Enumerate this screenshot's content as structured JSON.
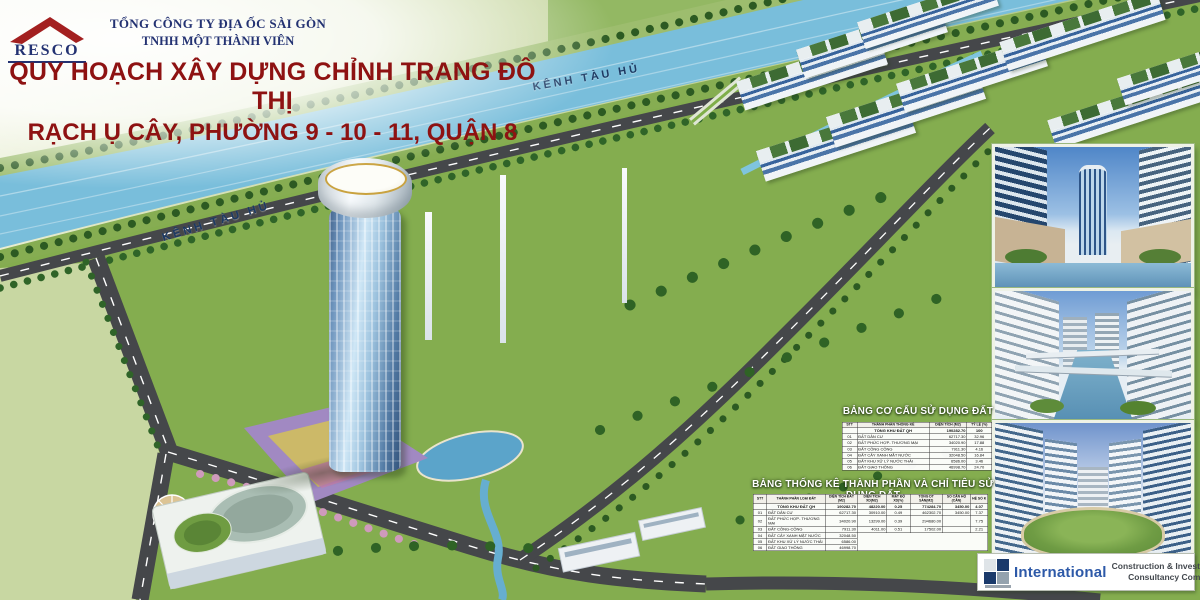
{
  "header": {
    "brand": "RESCO",
    "company_line1": "TỔNG CÔNG TY ĐỊA ỐC SÀI GÒN",
    "company_line2": "TNHH MỘT THÀNH VIÊN",
    "title_line1": "QUY HOẠCH XÂY DỰNG CHỈNH TRANG ĐÔ THỊ",
    "title_line2": "RẠCH Ụ CÂY, PHƯỜNG 9 - 10 - 11, QUẬN 8",
    "title_color": "#8e1212",
    "brand_color": "#a32020",
    "navy_color": "#233272"
  },
  "plan": {
    "canal_label": "KÊNH TÀU HỦ",
    "water_color": "#79bedb",
    "road_color": "#45474a",
    "lawn_color": "#84ad4f"
  },
  "land_use_table": {
    "title": "BẢNG CƠ CẤU SỬ DỤNG ĐẤT",
    "columns": [
      "STT",
      "THÀNH PHẦN THỐNG KÊ",
      "DIỆN TÍCH (M2)",
      "TỶ LỆ (%)"
    ],
    "total": {
      "label": "TỔNG KHU ĐẤT QH",
      "area": "190282.70",
      "ratio": "100"
    },
    "rows": [
      {
        "stt": "01",
        "label": "ĐẤT DÂN CƯ",
        "area": "62717.30",
        "ratio": "32.96"
      },
      {
        "stt": "02",
        "label": "ĐẤT PHỨC HỢP- THƯƠNG MẠI",
        "area": "34020.90",
        "ratio": "17.88"
      },
      {
        "stt": "03",
        "label": "ĐẤT CÔNG CỘNG",
        "area": "7911.30",
        "ratio": "4.16"
      },
      {
        "stt": "04",
        "label": "ĐẤT CÂY XANH MẶT NƯỚC",
        "area": "32048.50",
        "ratio": "16.84"
      },
      {
        "stt": "05",
        "label": "ĐẤT KHU XỬ LÝ NƯỚC THẢI",
        "area": "6586.00",
        "ratio": "3.46"
      },
      {
        "stt": "06",
        "label": "ĐẤT GIAO THÔNG",
        "area": "46998.70",
        "ratio": "24.70"
      }
    ]
  },
  "stats_table": {
    "title": "BẢNG THỐNG KÊ THÀNH PHẦN VÀ CHỈ TIÊU SỬ DỤNG ĐẤT",
    "columns": [
      "STT",
      "THÀNH PHẦN LOẠI ĐẤT",
      "DIỆN TÍCH ĐẤT (M2)",
      "DIỆN TÍCH XD(M2)",
      "MẬT ĐỘ XD(%)",
      "TỔNG DT SÀN(M2)",
      "SỐ CĂN HỘ (CĂN)",
      "HỆ SỐ K"
    ],
    "total": {
      "label": "TỔNG KHU ĐẤT QH",
      "area": "190282.70",
      "build_area": "48220.00",
      "density": "0.25",
      "floor_area": "774284.70",
      "units": "3450.00",
      "far": "4.07"
    },
    "rows": [
      {
        "stt": "01",
        "label": "ĐẤT DÂN CƯ",
        "area": "62717.30",
        "build_area": "30910.00",
        "density": "0.49",
        "floor_area": "462302.70",
        "units": "3450.00",
        "far": "7.37"
      },
      {
        "stt": "02",
        "label": "ĐẤT PHỨC HỢP- THƯƠNG MẠI",
        "area": "34020.90",
        "build_area": "13299.00",
        "density": "0.39",
        "floor_area": "294680.00",
        "units": "",
        "far": "7.75"
      },
      {
        "stt": "03",
        "label": "ĐẤT CÔNG-CỘNG",
        "area": "7911.30",
        "build_area": "4011.00",
        "density": "0.51",
        "floor_area": "17502.00",
        "units": "",
        "far": "2.21"
      },
      {
        "stt": "04",
        "label": "ĐẤT CÂY XANH MẶT NƯỚC",
        "area": "32048.50"
      },
      {
        "stt": "05",
        "label": "ĐẤT KHU XỬ LÝ NƯỚC THẢI",
        "area": "6586.00"
      },
      {
        "stt": "06",
        "label": "ĐẤT GIAO THÔNG",
        "area": "46998.70"
      }
    ]
  },
  "consultant": {
    "name": "International",
    "line1": "Construction & Investment",
    "line2": "Consultancy Company"
  }
}
